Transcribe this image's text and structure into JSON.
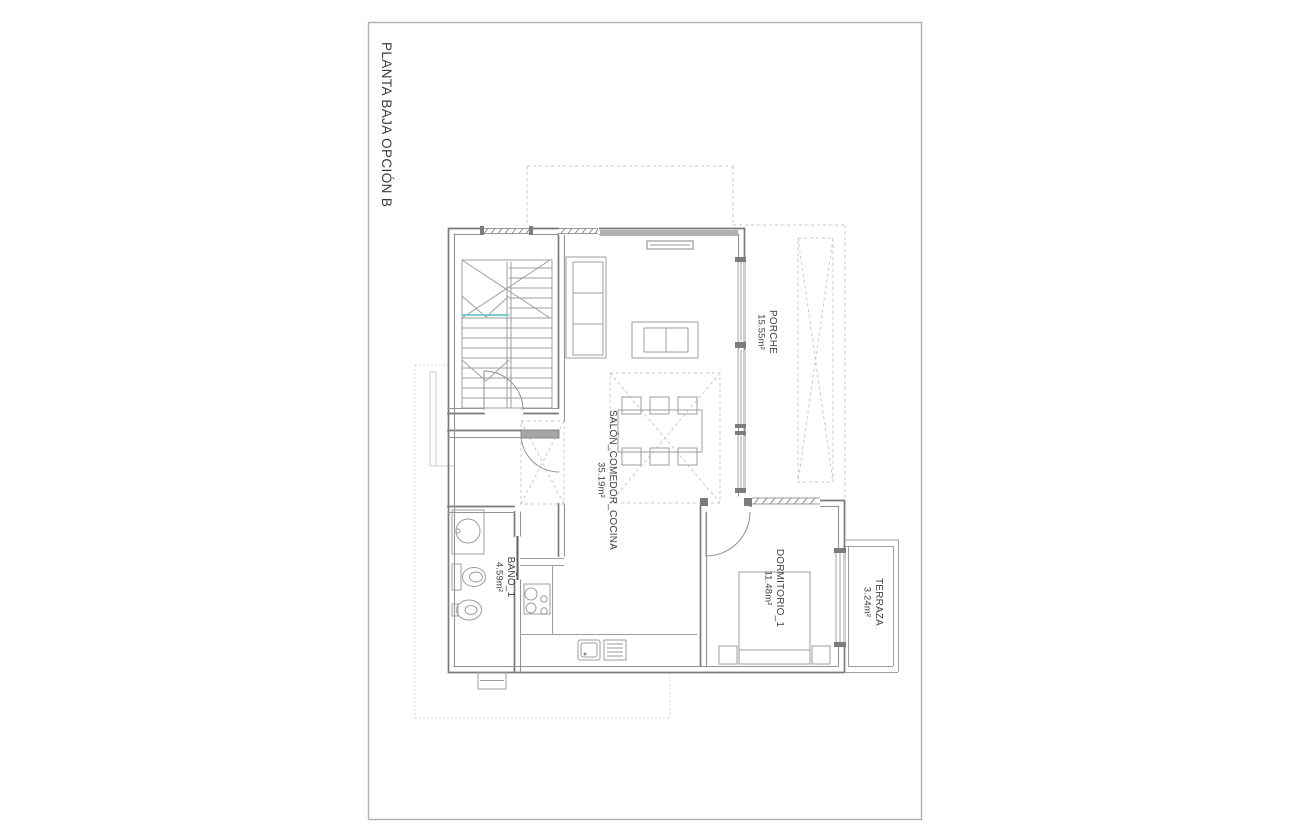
{
  "title": {
    "text": "PLANTA BAJA OPCIÓN B"
  },
  "rooms": {
    "porche": {
      "name": "PORCHE",
      "area": "15.55m²"
    },
    "salon": {
      "name": "SALÓN_COMEDOR_COCINA",
      "area": "35.19m²"
    },
    "bano": {
      "name": "BAÑO_1",
      "area": "4.59m²"
    },
    "dormitorio": {
      "name": "DORMITORIO_1",
      "area": "11.48m²"
    },
    "terraza": {
      "name": "TERRAZA",
      "area": "3.24m²"
    }
  },
  "colors": {
    "background": "#ffffff",
    "frame_border": "#b0b0b0",
    "wall": "#7a7a7a",
    "wall_light": "#939393",
    "furniture": "#9e9e9e",
    "dashed_guide": "#c8c8c8",
    "stair_accent": "#7bcccc",
    "label_text": "#3f3f3f"
  }
}
